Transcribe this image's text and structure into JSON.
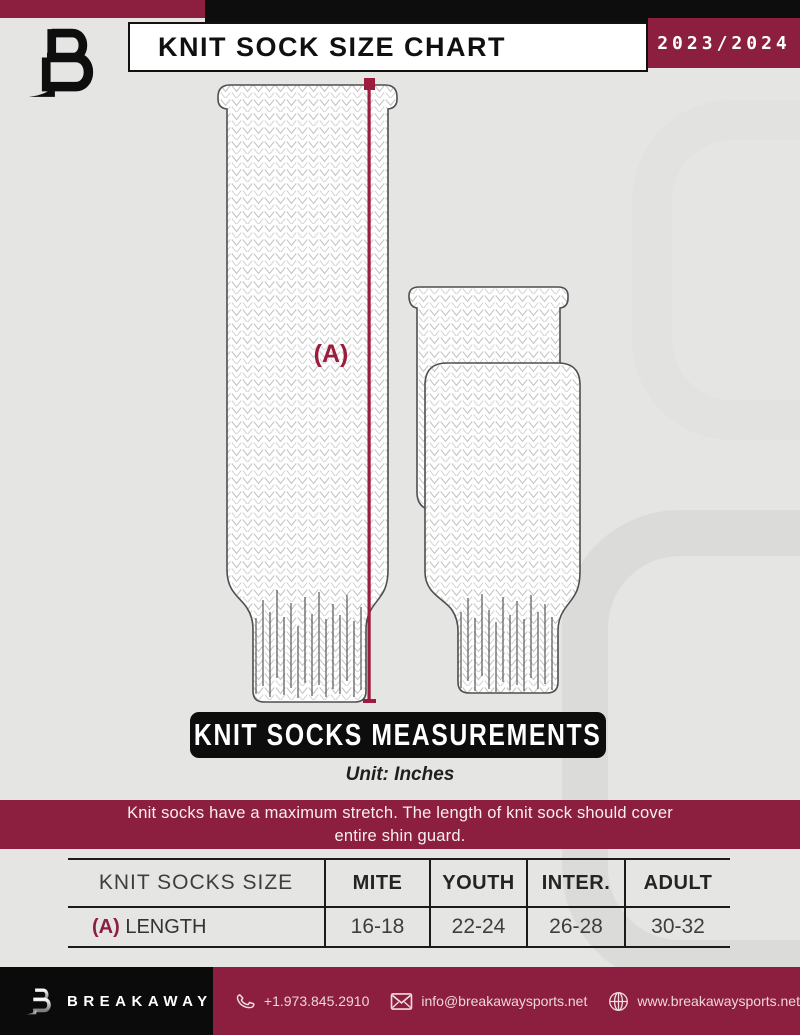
{
  "header": {
    "title": "KNIT SOCK SIZE CHART",
    "season": "2023/2024"
  },
  "diagram": {
    "measurement_label": "(A)"
  },
  "banners": {
    "measurements": "KNIT SOCKS MEASUREMENTS",
    "unit_note": "Unit: Inches",
    "stretch_note_line1": "Knit socks have a maximum stretch. The length of knit sock should cover",
    "stretch_note_line2": "entire shin guard."
  },
  "size_table": {
    "columns": [
      "KNIT SOCKS SIZE",
      "MITE",
      "YOUTH",
      "INTER.",
      "ADULT"
    ],
    "row": {
      "key": "(A)",
      "label": "LENGTH",
      "values": [
        "16-18",
        "22-24",
        "26-28",
        "30-32"
      ]
    }
  },
  "footer": {
    "brand": "BREAKAWAY",
    "phone": "+1.973.845.2910",
    "email": "info@breakawaysports.net",
    "website": "www.breakawaysports.net"
  },
  "icons": {
    "phone": "phone-icon",
    "email": "email-icon",
    "website": "globe-icon",
    "brand": "breakaway-b-logo"
  },
  "colors": {
    "maroon": "#8C1F3F",
    "accent_red": "#9B1C3C",
    "black": "#0D0D0D",
    "page_bg": "#E5E5E4"
  }
}
